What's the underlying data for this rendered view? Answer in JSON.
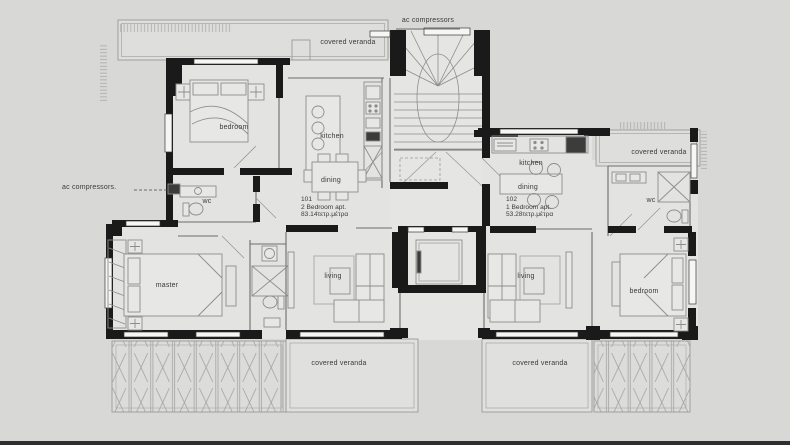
{
  "window": {
    "background": "#d8d8d6",
    "footer_bar_color": "#2f2f2f"
  },
  "plan": {
    "core": {
      "ac_compressors_top_label": "ac compressors",
      "ac_compressors_left_label": "ac compressors.",
      "stairwell_icon": "staircase",
      "elevator_icon": "elevator"
    },
    "verandas": {
      "top_left": "covered veranda",
      "top_right": "covered veranda",
      "bottom_left": "covered veranda",
      "bottom_right": "covered veranda"
    },
    "apartment_101": {
      "number": "101",
      "type": "2 Bedroom apt.",
      "area": "83.14τετρ.μέτρα",
      "rooms": {
        "bedroom": "bedroom",
        "kitchen": "kitchen",
        "dining": "dining",
        "wc": "wc",
        "master": "master",
        "living": "living"
      }
    },
    "apartment_102": {
      "number": "102",
      "type": "1 Bedroom apt.",
      "area": "53.28τετρ.μέτρα",
      "rooms": {
        "kitchen": "kitchen",
        "dining": "dining",
        "wc": "wc",
        "living": "living",
        "bedroom": "bedroom"
      }
    },
    "colors": {
      "wall": "#1a1a1a",
      "thin_line": "#6e6e6c",
      "floor": "#e3e3e1",
      "text": "#3a3a3a"
    }
  }
}
